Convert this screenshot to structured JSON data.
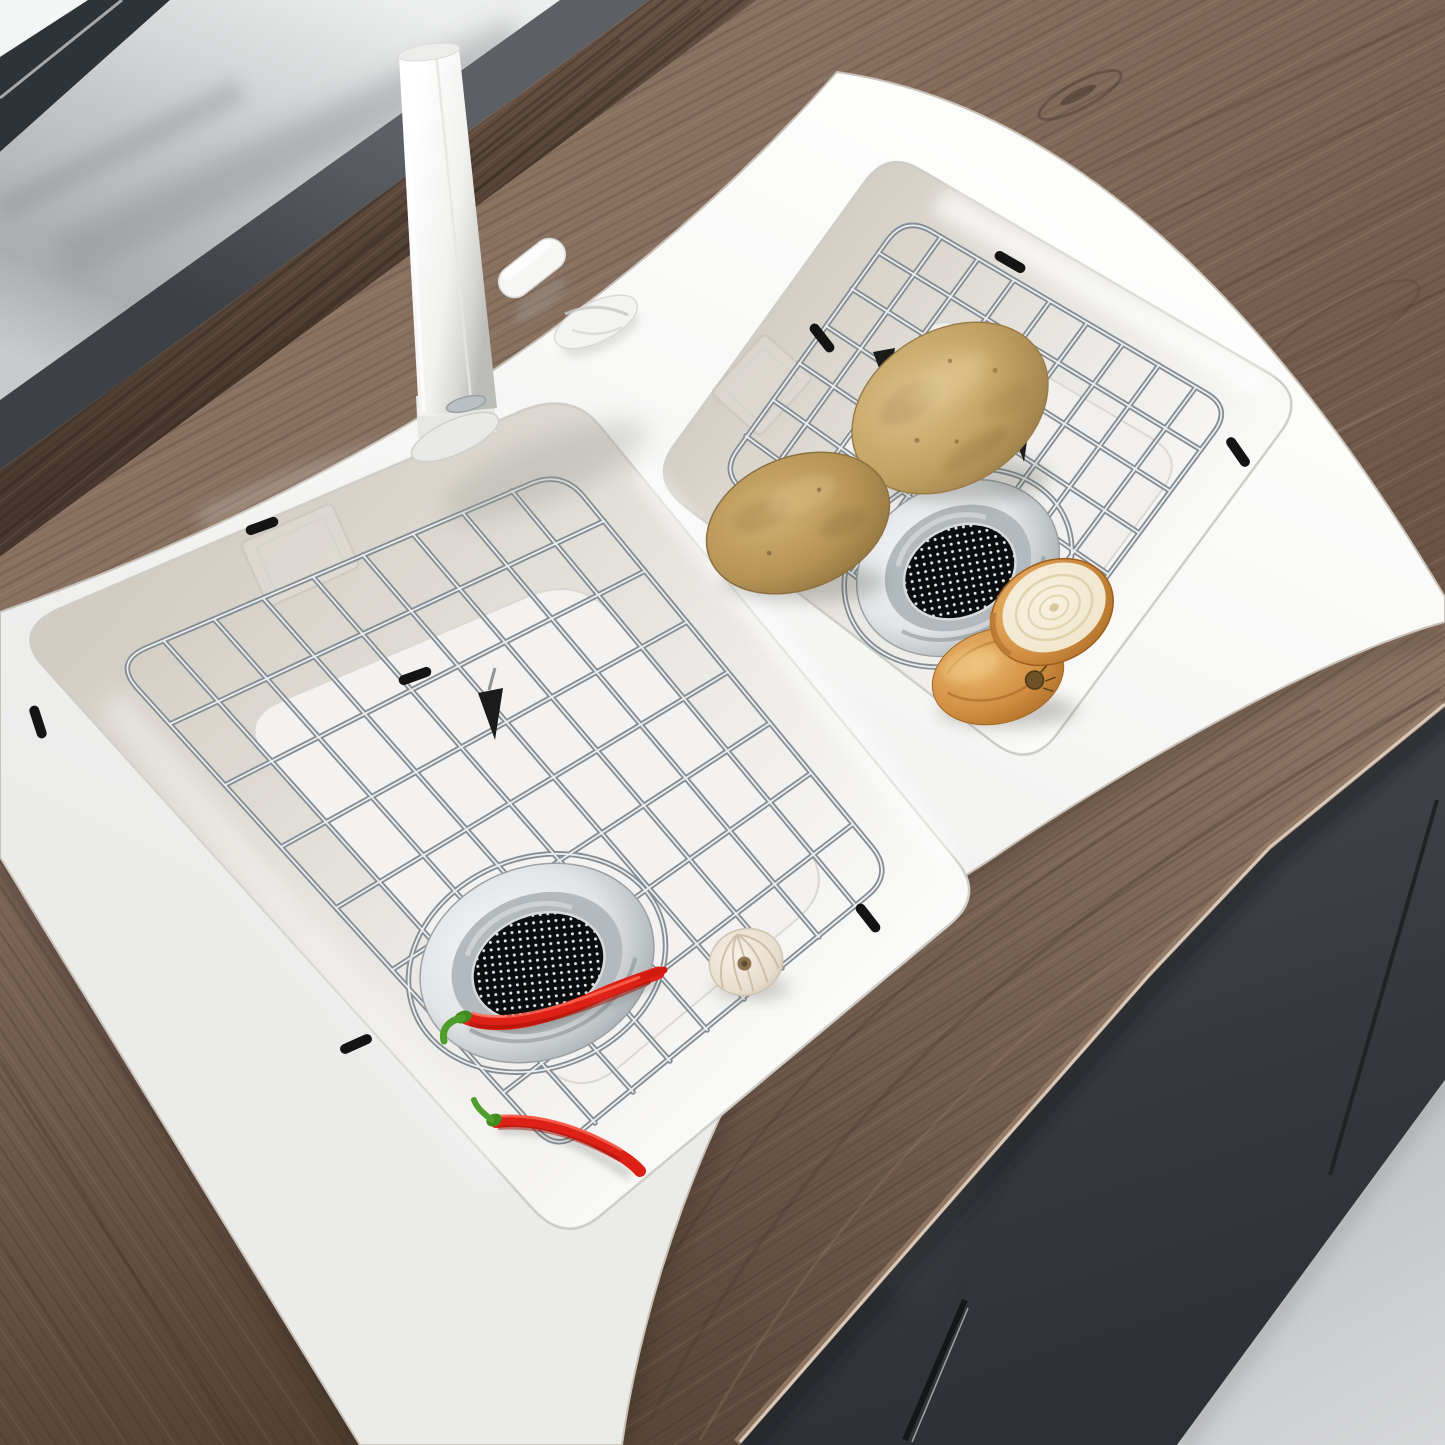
{
  "meta": {
    "type": "product-photograph-3d-render",
    "description": "Top-angle render of a white double-bowl drop-in kitchen sink with stainless-steel bottom grids and strainer drains, a tall white modern faucet, set into a walnut-wood countertop with a grey glossy windowsill behind and dark grey cabinets below; potatoes, onion halves, a garlic bulb and red chili peppers lie on the grids.",
    "image_size": {
      "width": 1445,
      "height": 1445
    }
  },
  "palette": {
    "glassWhite": "#f4f5f5",
    "frameDark": "#2e3337",
    "sillLight": "#e9eaeb",
    "sillMid": "#b9bcbe",
    "sillDark": "#4a4e52",
    "upstandMid": "#5d4839",
    "upstandDark": "#3e2f25",
    "woodLight": "#a08772",
    "woodMid": "#87705f",
    "woodDark": "#5f4b3e",
    "woodDeep": "#42332a",
    "edgeLine": "#dccdbe",
    "sinkWhite": "#f7f7f6",
    "deckBright": "#fdfdfc",
    "deckShade": "#e7e7e6",
    "bowlBeige": "#d1cbc0",
    "bowlWhite": "#f2f1ef",
    "wireDark": "#878e93",
    "wireLight": "#eaeef0",
    "bumperBlack": "#141414",
    "chromeLight": "#f6f7f8",
    "chromeMid": "#c6cbce",
    "chromeDark": "#878d91",
    "meshDark": "#0c0d0e",
    "meshDot": "#e4e7e8",
    "potatoLight": "#dcc08a",
    "potatoMid": "#c2a263",
    "potatoDark": "#8e7140",
    "onionSkin": "#cf8c41",
    "onionSkinDeep": "#a3661f",
    "onionFlesh": "#f4ecd8",
    "onionRing": "#dccfa8",
    "garlicLight": "#f4eee3",
    "garlicShade": "#c9bba6",
    "chiliRed": "#dd2116",
    "chiliDarkRed": "#a31008",
    "chiliStem": "#4f9e2b",
    "cabinetDark": "#35393d",
    "cabinetDeep": "#2b2f33",
    "seamDark": "#1f2326",
    "floorLight": "#d3d4d6",
    "floorMid": "#bfc1c3"
  },
  "objects": {
    "window": {
      "label": "window glass pane",
      "color": "#f4f5f5"
    },
    "window_frame": {
      "label": "dark window frame",
      "color": "#2e3337"
    },
    "windowsill": {
      "label": "glossy grey windowsill ledge",
      "color": "#b9bcbe"
    },
    "backsplash": {
      "label": "dark walnut backsplash upstand",
      "color": "#5d4839"
    },
    "countertop": {
      "label": "walnut wood countertop",
      "color": "#87705f"
    },
    "sink": {
      "label": "white double-bowl drop-in kitchen sink",
      "color": "#f7f7f6"
    },
    "faucet": {
      "label": "tall white modern kitchen faucet",
      "color": "#f4f4f2"
    },
    "faucet_handle": {
      "label": "white faucet side handle",
      "color": "#f6f6f4"
    },
    "deck_cap": {
      "label": "white deck hole cap / soap dispenser cap",
      "color": "#f3f3f1"
    },
    "left_bowl": {
      "label": "large front sink bowl",
      "color": "#f2f1ef"
    },
    "right_bowl": {
      "label": "rear sink bowl",
      "color": "#f1f0ee"
    },
    "left_grid": {
      "label": "stainless steel bottom grid (front bowl)",
      "color": "#aeb4b8"
    },
    "right_grid": {
      "label": "stainless steel bottom grid (rear bowl)",
      "color": "#aeb4b8"
    },
    "left_drain": {
      "label": "strainer drain with mesh basket (front bowl)",
      "color": "#c6cbce"
    },
    "right_drain": {
      "label": "strainer drain with mesh basket (rear bowl)",
      "color": "#c6cbce"
    },
    "left_overflow": {
      "label": "recessed overflow plate (front bowl)",
      "color": "#e2dfd9"
    },
    "right_overflow": {
      "label": "recessed overflow plate (rear bowl)",
      "color": "#e2dfd9"
    },
    "potato_1": {
      "label": "russet potato (upper)",
      "color": "#c2a263"
    },
    "potato_2": {
      "label": "russet potato (lower)",
      "color": "#b59455"
    },
    "onion_cut": {
      "label": "halved onion, cut face up",
      "color": "#f4ecd8"
    },
    "onion_skin": {
      "label": "halved onion, skin side with root",
      "color": "#cf8c41"
    },
    "garlic": {
      "label": "garlic bulb",
      "color": "#f4eee3"
    },
    "chili_1": {
      "label": "red chili pepper on strainer",
      "color": "#dd2116"
    },
    "chili_2": {
      "label": "red chili pepper on grid",
      "color": "#dd2116"
    },
    "cabinet": {
      "label": "dark grey base cabinets",
      "color": "#35393d"
    },
    "floor": {
      "label": "light grey floor",
      "color": "#d3d4d6"
    }
  }
}
